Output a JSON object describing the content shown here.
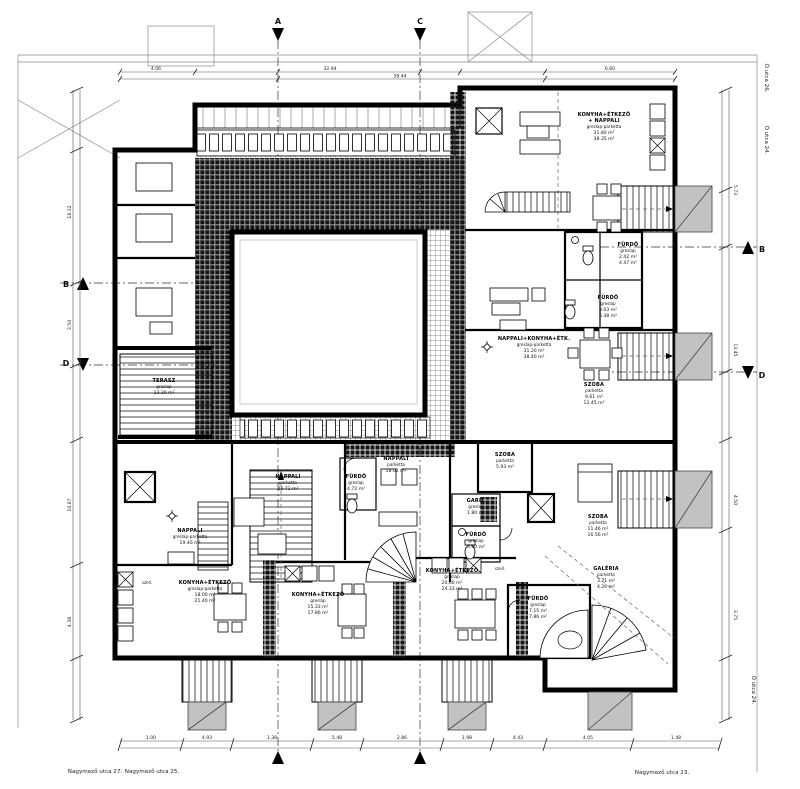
{
  "colors": {
    "wall": "#000000",
    "balcony": "#c2c2c2",
    "paper": "#ffffff",
    "dimline": "#444444"
  },
  "markers": {
    "a": "A",
    "b": "B",
    "c": "C",
    "d": "D"
  },
  "streets": {
    "s1": "Nagymező utca 27.",
    "s2": "Nagymező utca 25.",
    "s3": "Nagymező utca 23.",
    "o1": "Ó utca 26.",
    "o2": "Ó utca 24."
  },
  "misc": {
    "vent": "szell."
  },
  "dims": {
    "top": [
      "4.06",
      "32.94",
      "6.60",
      "38.44"
    ],
    "bottom": [
      "1.00",
      "4.93",
      "1.38",
      "5.48",
      "2.86",
      "1.98",
      "4.43",
      "4.05",
      "1.48"
    ],
    "left": [
      "16.32",
      "3.50",
      "10.67",
      "4.38"
    ],
    "right": [
      "5.73",
      "13.45",
      "4.50",
      "3.75"
    ]
  },
  "rooms": [
    {
      "name": "KONYHA+ÉTKEZŐ",
      "name2": "+ NAPPALI",
      "finish": "greslap-parketta",
      "a1": "31.80 m²",
      "a2": "38.35 m²"
    },
    {
      "name": "FÜRDŐ",
      "finish": "greslap",
      "a1": "2.42 m²",
      "a2": "4.47 m²"
    },
    {
      "name": "FÜRDŐ",
      "finish": "greslap",
      "a1": "3.03 m²",
      "a2": "5.38 m²"
    },
    {
      "name": "NAPPALI+KONYHA+ÉTK.",
      "finish": "greslap-parketta",
      "a1": "31.20 m²",
      "a2": "38.40 m²"
    },
    {
      "name": "SZOBA",
      "finish": "parketta",
      "a1": "9.61 m²",
      "a2": "12.45 m²"
    },
    {
      "name": "SZOBA",
      "finish": "parketta",
      "a1": "5.93 m²"
    },
    {
      "name": "SZOBA",
      "finish": "parketta",
      "a1": "11.46 m²",
      "a2": "16.56 m²"
    },
    {
      "name": "GALÉRIA",
      "finish": "parketta",
      "a1": "3.71 m²",
      "a2": "4.26 m²"
    },
    {
      "name": "GARD.",
      "finish": "greslap",
      "a1": "1.80 m²"
    },
    {
      "name": "FÜRDŐ",
      "finish": "greslap",
      "a1": "3.60 m²"
    },
    {
      "name": "FÜRDŐ",
      "finish": "greslap",
      "a1": "7.15 m²",
      "a2": "7.86 m²"
    },
    {
      "name": "NAPPALI",
      "finish": "parketta",
      "a1": "18.02 m²"
    },
    {
      "name": "FÜRDŐ",
      "finish": "greslap",
      "a1": "4.72 m²"
    },
    {
      "name": "NAPPALI",
      "finish": "parketta",
      "a1": "26.72 m²"
    },
    {
      "name": "NAPPALI",
      "finish": "greslap-parketta",
      "a1": "19.40 m²"
    },
    {
      "name": "KONYHA+ÉTKEZŐ",
      "finish": "greslap-parketta",
      "a1": "18.00 m²",
      "a2": "21.40 m²"
    },
    {
      "name": "KONYHA+ÉTKEZŐ",
      "finish": "greslap",
      "a1": "15.33 m²",
      "a2": "17.86 m²"
    },
    {
      "name": "KONYHA+ÉTKEZŐ",
      "finish": "greslap",
      "a1": "20.60 m²",
      "a2": "24.33 m²"
    },
    {
      "name": "TERASZ",
      "finish": "greslap",
      "a1": "23.30 m²"
    }
  ]
}
